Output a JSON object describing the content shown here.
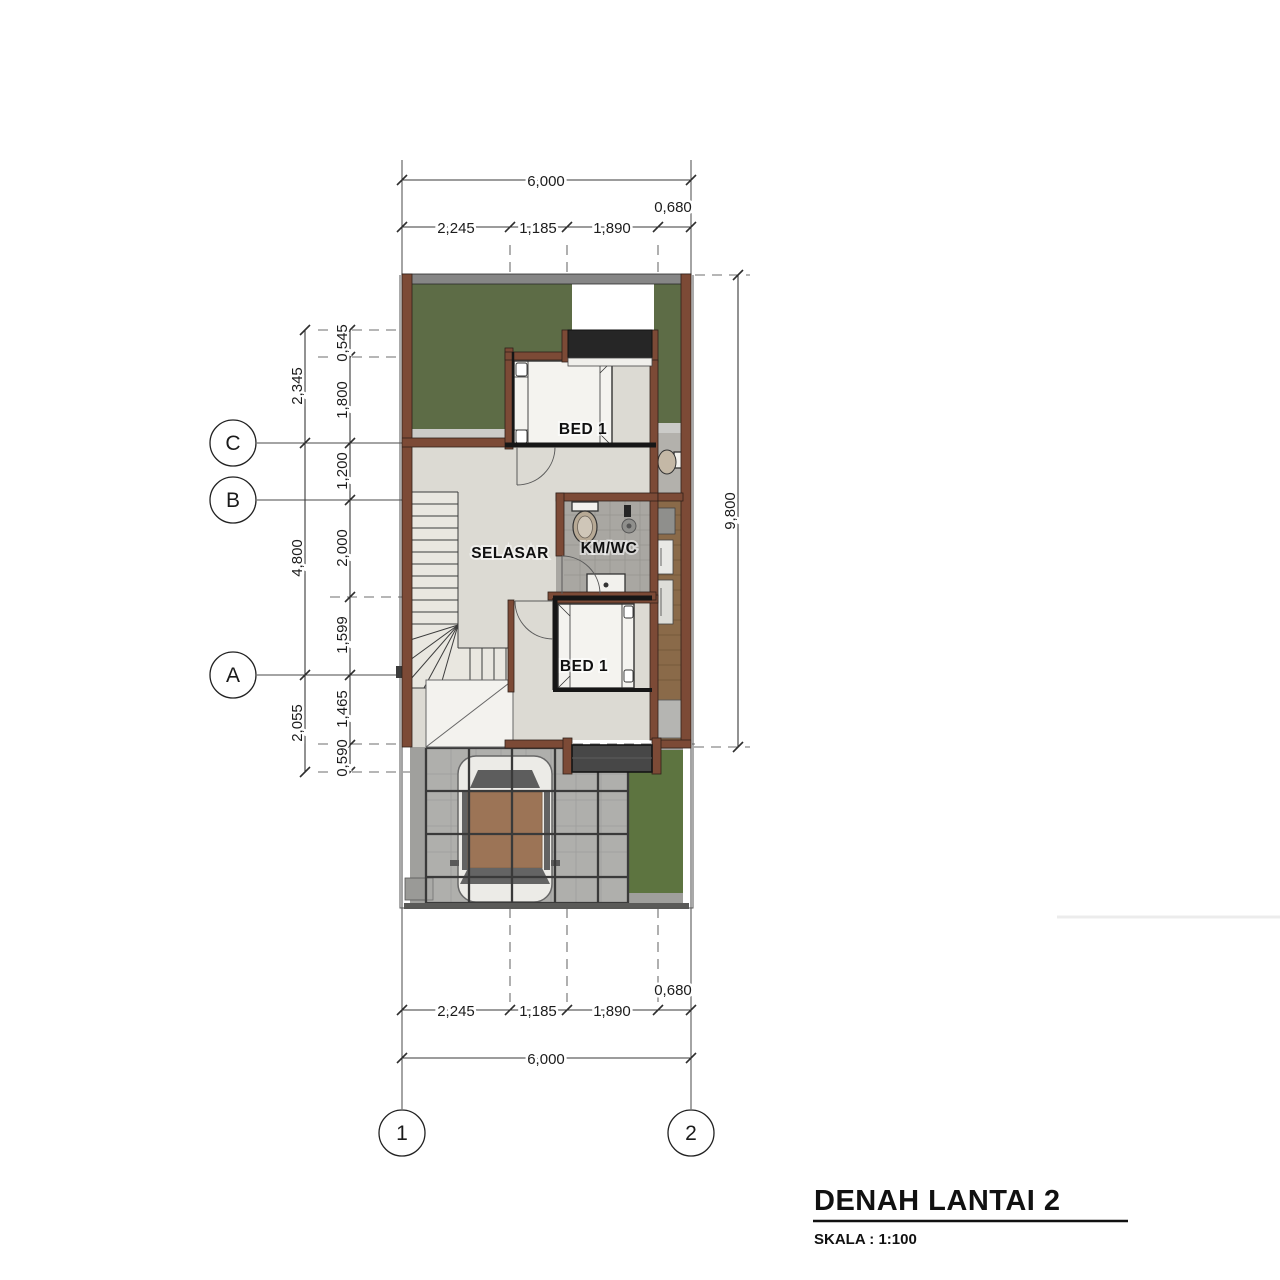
{
  "title": {
    "main": "DENAH LANTAI 2",
    "scale": "SKALA : 1:100"
  },
  "rooms": {
    "bed_top": "BED 1",
    "bed_bottom": "BED 1",
    "selasar": "SELASAR",
    "kmwc": "KM/WC"
  },
  "grid_bubbles": {
    "c": "C",
    "b": "B",
    "a": "A",
    "g1": "1",
    "g2": "2"
  },
  "dimensions": {
    "top_total": "6,000",
    "top_segments": [
      "2,245",
      "1,185",
      "1,890"
    ],
    "top_offset": "0,680",
    "bottom_total": "6,000",
    "bottom_segments": [
      "2,245",
      "1,185",
      "1,890"
    ],
    "bottom_offset": "0,680",
    "left_outer": [
      "2,345",
      "4,800",
      "2,055"
    ],
    "left_inner": [
      "0,545",
      "1,800",
      "1,200",
      "2,000",
      "1,599",
      "1,465",
      "0,590"
    ],
    "right_total": "9,800"
  },
  "colors": {
    "wall_brown": "#7c4a36",
    "roof_green": "#5d6c46",
    "lawn_green": "#5d7440",
    "floor_light": "#dcdad3",
    "kmwc_floor": "#a9a7a2",
    "planter_black": "#262626",
    "wood_deck": "#8a6a49",
    "paving_gray": "#a0a09d",
    "canopy_white": "#f3f2ee"
  }
}
